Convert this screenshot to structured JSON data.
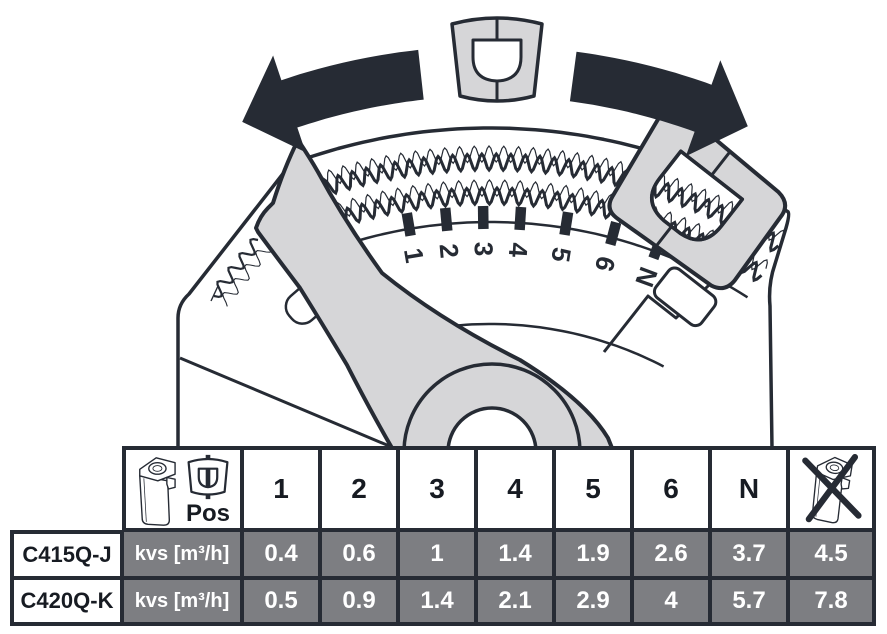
{
  "dial": {
    "positions": [
      "1",
      "2",
      "3",
      "4",
      "5",
      "6",
      "N"
    ]
  },
  "table": {
    "pos_label": "Pos",
    "position_headers": [
      "1",
      "2",
      "3",
      "4",
      "5",
      "6",
      "N"
    ],
    "rows": [
      {
        "model": "C415Q-J",
        "unit": "kvs [m³/h]",
        "values": [
          "0.4",
          "0.6",
          "1",
          "1.4",
          "1.9",
          "2.6",
          "3.7",
          "4.5"
        ]
      },
      {
        "model": "C420Q-K",
        "unit": "kvs [m³/h]",
        "values": [
          "0.5",
          "0.9",
          "1.4",
          "2.1",
          "2.9",
          "4",
          "5.7",
          "7.8"
        ]
      }
    ]
  },
  "colors": {
    "ink": "#262b34",
    "light_gray": "#d6d6d8",
    "cell_gray": "#7d7e82"
  }
}
